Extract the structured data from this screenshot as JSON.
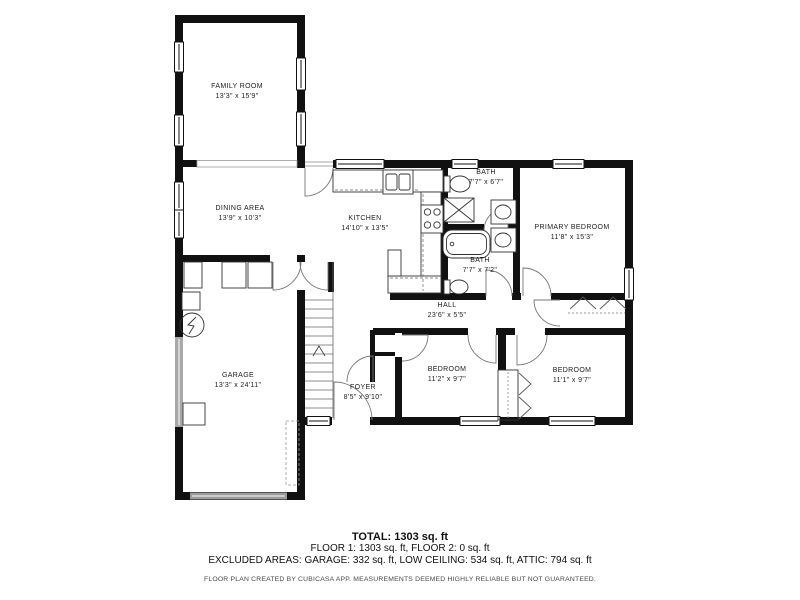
{
  "plan": {
    "rooms": [
      {
        "name": "FAMILY ROOM",
        "dims": "13'3\" x 15'9\""
      },
      {
        "name": "DINING AREA",
        "dims": "13'9\" x 10'3\""
      },
      {
        "name": "KITCHEN",
        "dims": "14'10\" x 13'5\""
      },
      {
        "name": "BATH",
        "dims": "7'7\" x 6'7\""
      },
      {
        "name": "PRIMARY BEDROOM",
        "dims": "11'8\" x 15'3\""
      },
      {
        "name": "BATH",
        "dims": "7'7\" x 7'2\""
      },
      {
        "name": "HALL",
        "dims": "23'6\" x 5'5\""
      },
      {
        "name": "GARAGE",
        "dims": "13'3\" x 24'11\""
      },
      {
        "name": "FOYER",
        "dims": "8'5\" x 9'10\""
      },
      {
        "name": "BEDROOM",
        "dims": "11'2\" x 9'7\""
      },
      {
        "name": "BEDROOM",
        "dims": "11'1\" x 9'7\""
      }
    ],
    "footer": {
      "total": "TOTAL: 1303 sq. ft",
      "floors": "FLOOR 1: 1303 sq. ft, FLOOR 2: 0 sq. ft",
      "excluded": "EXCLUDED AREAS: GARAGE: 332 sq. ft, LOW CEILING: 534 sq. ft, ATTIC: 794 sq. ft",
      "disclaimer": "FLOOR PLAN CREATED BY CUBICASA APP. MEASUREMENTS DEEMED HIGHLY RELIABLE BUT NOT GUARANTEED."
    },
    "colors": {
      "wall": "#111111",
      "garage_door": "#9a9a9a",
      "thin_line": "#555555"
    }
  }
}
